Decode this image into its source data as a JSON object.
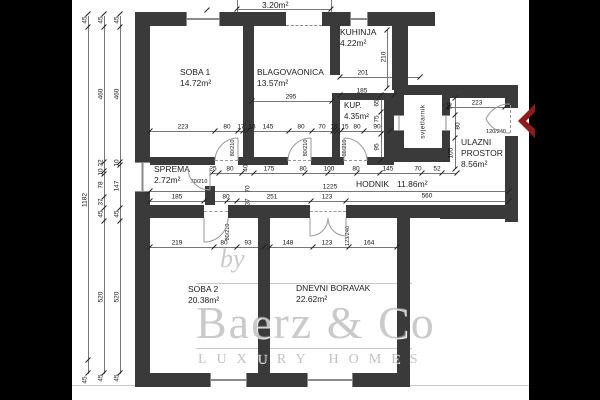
{
  "watermark": {
    "by": "by",
    "brand": "Baerz & Co",
    "tagline": "LUXURY HOMES"
  },
  "colors": {
    "wall": "#3a3a3a",
    "entry_arrow": "#8e1b1b",
    "watermark_gray": "#969696"
  },
  "rooms": {
    "soba1": {
      "name": "SOBA 1",
      "area": "14.72m²"
    },
    "blagovaonica": {
      "name": "BLAGOVAONICA",
      "area": "13.57m²"
    },
    "kuhinja": {
      "name": "KUHINJA",
      "area": "4.22m²"
    },
    "kupaonica": {
      "name": "KUP.",
      "area": "4.35m²"
    },
    "sprema": {
      "name": "SPREMA",
      "area": "2.72m²"
    },
    "hodnik": {
      "name": "HODNIK",
      "area": "11.86m²"
    },
    "ulazni_prostor": {
      "name": "ULAZNI PROSTOR",
      "area": "8.56m²"
    },
    "soba2": {
      "name": "SOBA 2",
      "area": "20.38m²"
    },
    "dnevni_boravak": {
      "name": "DNEVNI BORAVAK",
      "area": "22.62m²"
    },
    "svjetlarnik": {
      "name": "svjetlarnik"
    },
    "balkon": {
      "area": "3.20m²"
    }
  },
  "doors": {
    "interior": "80/210",
    "sprema": "70/210",
    "dnevni": "123/240",
    "entry": "120/240"
  },
  "dimensions": {
    "chain_outer": [
      "45",
      "1182",
      "45"
    ],
    "chain_mid": [
      "45",
      "460",
      "32",
      "10",
      "78",
      "37",
      "45",
      "520",
      "45"
    ],
    "chain_inner": [
      "45",
      "460",
      "10",
      "147",
      "45",
      "520",
      "45"
    ],
    "row_rooms_top": [
      "223",
      "80",
      "17",
      "13",
      "145",
      "80",
      "70",
      "15",
      "15",
      "80",
      "90"
    ],
    "row_hodnik_north": [
      "25",
      "80",
      "40",
      "175",
      "80",
      "100",
      "80",
      "145",
      "70",
      "52"
    ],
    "hodnik_total": "1225",
    "row_hodnik_south": [
      "185",
      "80",
      "70",
      "37",
      "251",
      "123"
    ],
    "entry_width": "560",
    "row_rooms_bottom": [
      "219",
      "80",
      "93",
      "148",
      "123",
      "164"
    ],
    "kuhinja_dims": [
      "201",
      "210",
      "295"
    ],
    "kup_dims": [
      "185",
      "65",
      "75",
      "95"
    ],
    "ulaz_dims": [
      "58",
      "223",
      "80",
      "105"
    ]
  }
}
